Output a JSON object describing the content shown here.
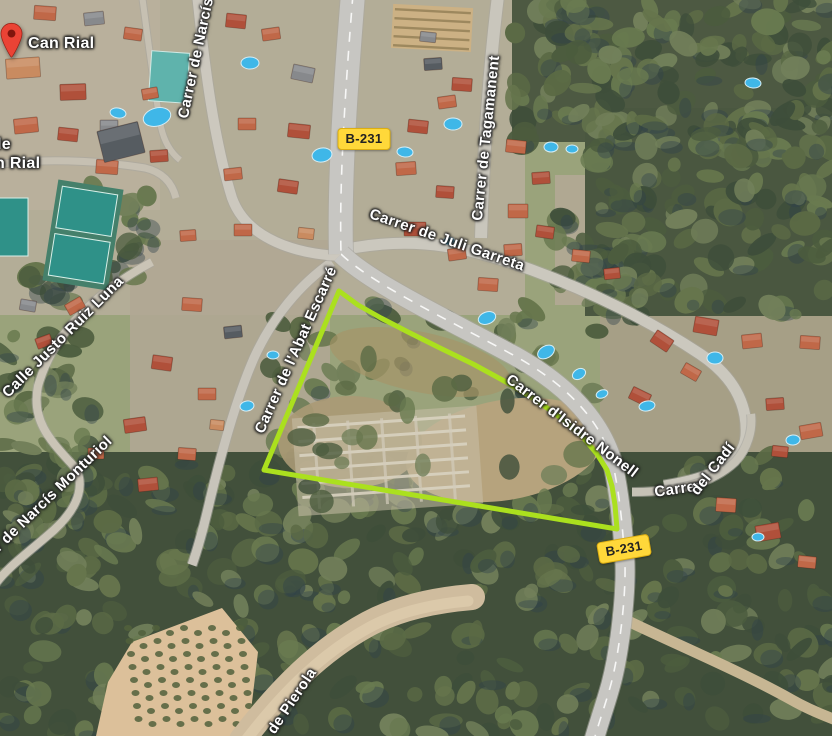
{
  "map": {
    "view": "satellite",
    "place_pin": {
      "label": "Can Rial",
      "tip_x": 11,
      "tip_y": 57,
      "color": "#EA4335"
    },
    "partial_place_label": {
      "line1": "le",
      "line1_x": -3,
      "line1_y": 136,
      "line2": "n Rial",
      "line2_x": -5,
      "line2_y": 155
    },
    "street_labels": [
      {
        "name": "carrer-de-narcis",
        "text": "Carrer de Narcís",
        "x": 196,
        "y": 58,
        "rotation": -78
      },
      {
        "name": "carrer-de-tagamanent",
        "text": "Carrer de Tagamanent",
        "x": 486,
        "y": 138,
        "rotation": -84
      },
      {
        "name": "carrer-de-juli-garreta",
        "text": "Carrer de Juli Garreta",
        "x": 447,
        "y": 240,
        "rotation": 19
      },
      {
        "name": "calle-justo-ruiz-luna",
        "text": "Calle Justo Ruiz Luna",
        "x": 63,
        "y": 337,
        "rotation": -45
      },
      {
        "name": "carrer-de-l-abat-escarre",
        "text": "Carrer de l'Abat Escarré",
        "x": 296,
        "y": 350,
        "rotation": -66
      },
      {
        "name": "carrer-d-isidre-nonell",
        "text": "Carrer d'Isidre Nonell",
        "x": 572,
        "y": 426,
        "rotation": 37
      },
      {
        "name": "carrer-del-cadi-part-1",
        "text": "Carrer",
        "x": 678,
        "y": 489,
        "rotation": -8
      },
      {
        "name": "carrer-del-cadi-part-2",
        "text": "del Cadí",
        "x": 713,
        "y": 469,
        "rotation": -52
      },
      {
        "name": "carrer-de-narcis-monturiol",
        "text": "Carrer de Narcís Monturiol",
        "x": 38,
        "y": 508,
        "rotation": -44
      },
      {
        "name": "de-pierola",
        "text": "de Pierola",
        "x": 292,
        "y": 701,
        "rotation": -56
      }
    ],
    "route_badges": [
      {
        "text": "B-231",
        "x": 364,
        "y": 139,
        "rotation": 0
      },
      {
        "text": "B-231",
        "x": 624,
        "y": 549,
        "rotation": -10
      }
    ],
    "plot_outline": {
      "color": "#ABE01E",
      "stroke_width": 5,
      "points": [
        [
          339,
          291
        ],
        [
          358,
          305
        ],
        [
          381,
          318
        ],
        [
          408,
          332
        ],
        [
          440,
          348
        ],
        [
          473,
          364
        ],
        [
          506,
          382
        ],
        [
          536,
          400
        ],
        [
          561,
          418
        ],
        [
          582,
          436
        ],
        [
          597,
          454
        ],
        [
          607,
          470
        ],
        [
          612,
          486
        ],
        [
          615,
          505
        ],
        [
          617,
          529
        ],
        [
          264,
          470
        ]
      ]
    },
    "colors": {
      "route_badge_bg": "#FFD83A",
      "route_badge_text": "#222222",
      "pin_red": "#EA4335",
      "label_text": "#ffffff"
    }
  }
}
